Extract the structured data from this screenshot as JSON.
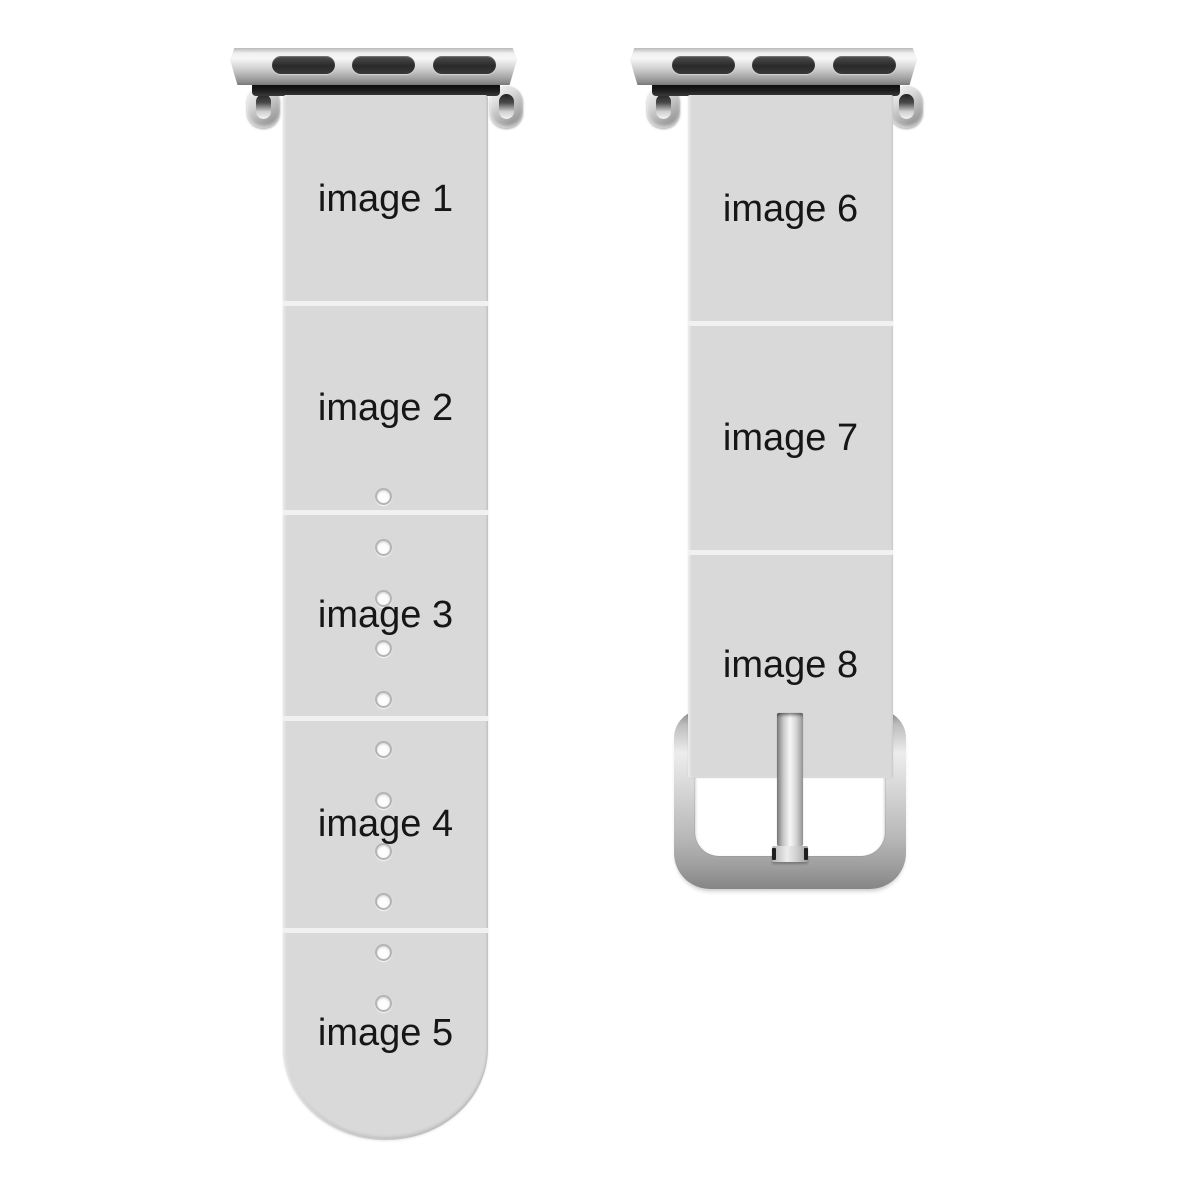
{
  "product": {
    "description": "custom watch band photo template",
    "left_band": {
      "segments": [
        {
          "label": "image 1"
        },
        {
          "label": "image 2"
        },
        {
          "label": "image 3"
        },
        {
          "label": "image 4"
        },
        {
          "label": "image 5"
        }
      ],
      "hole_count": 11
    },
    "right_band": {
      "segments": [
        {
          "label": "image 6"
        },
        {
          "label": "image 7"
        },
        {
          "label": "image 8"
        }
      ]
    }
  },
  "colors": {
    "background": "#ffffff",
    "strap": "#d9d9d9",
    "segment_divider": "#f1f1f1",
    "label_text": "#161616",
    "metal_light": "#f7f7f7",
    "metal_dark": "#787878",
    "adapter_slot": "#2a2a2a"
  }
}
